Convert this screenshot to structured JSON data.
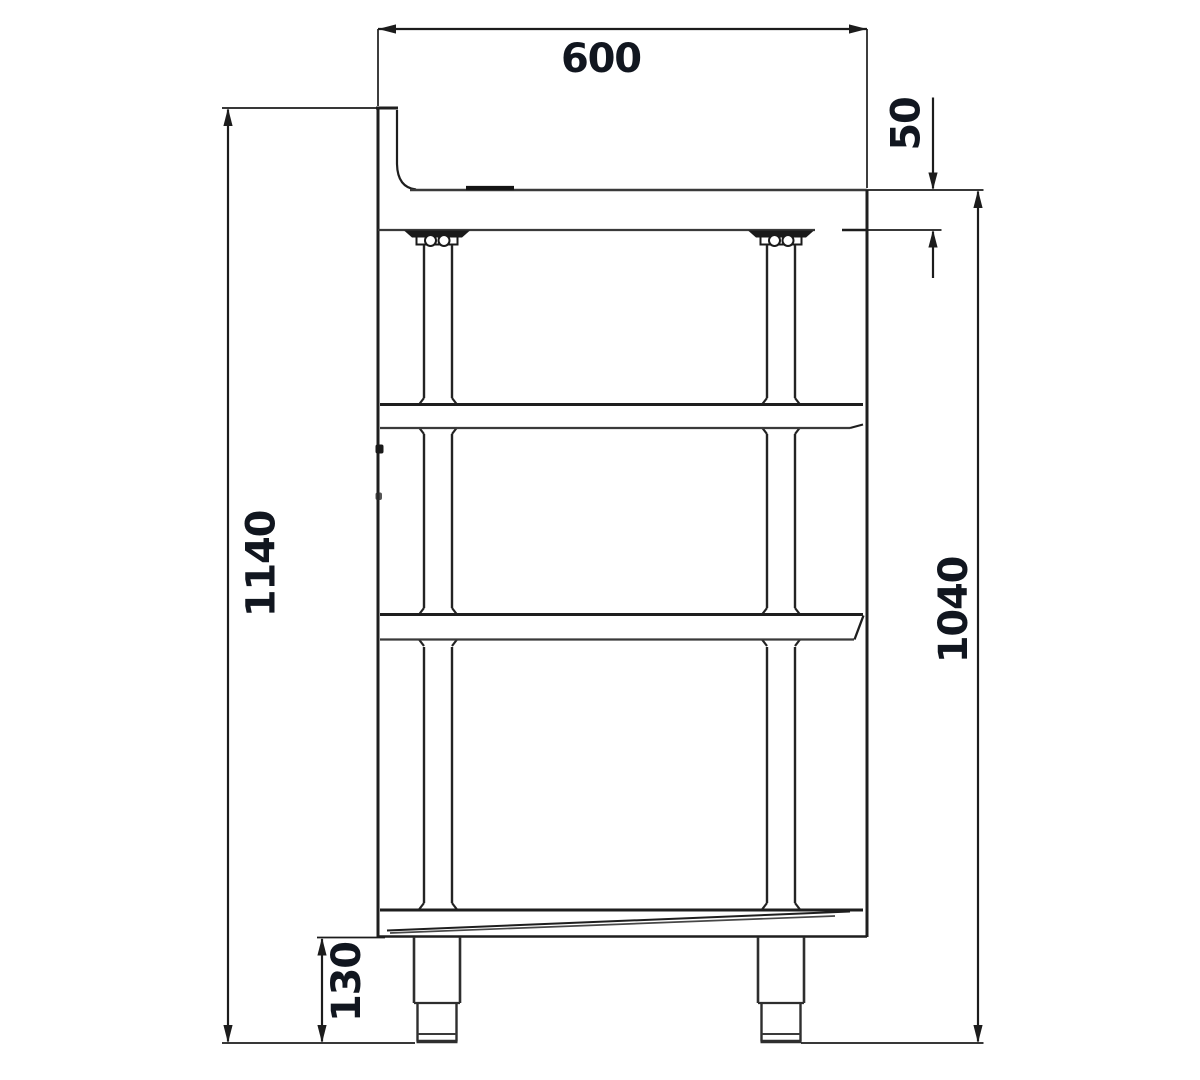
{
  "page": {
    "background_color": "#ffffff"
  },
  "drawing": {
    "stroke_color": "#1e1e1e",
    "light_stroke_color": "#3a3a3a",
    "dimension_text_color": "#11161f",
    "dimensions": {
      "top_depth_mm": "600",
      "top_thickness_mm": "50",
      "overall_height_mm": "1140",
      "height_to_worktop_mm": "1040",
      "foot_height_mm": "130"
    }
  }
}
